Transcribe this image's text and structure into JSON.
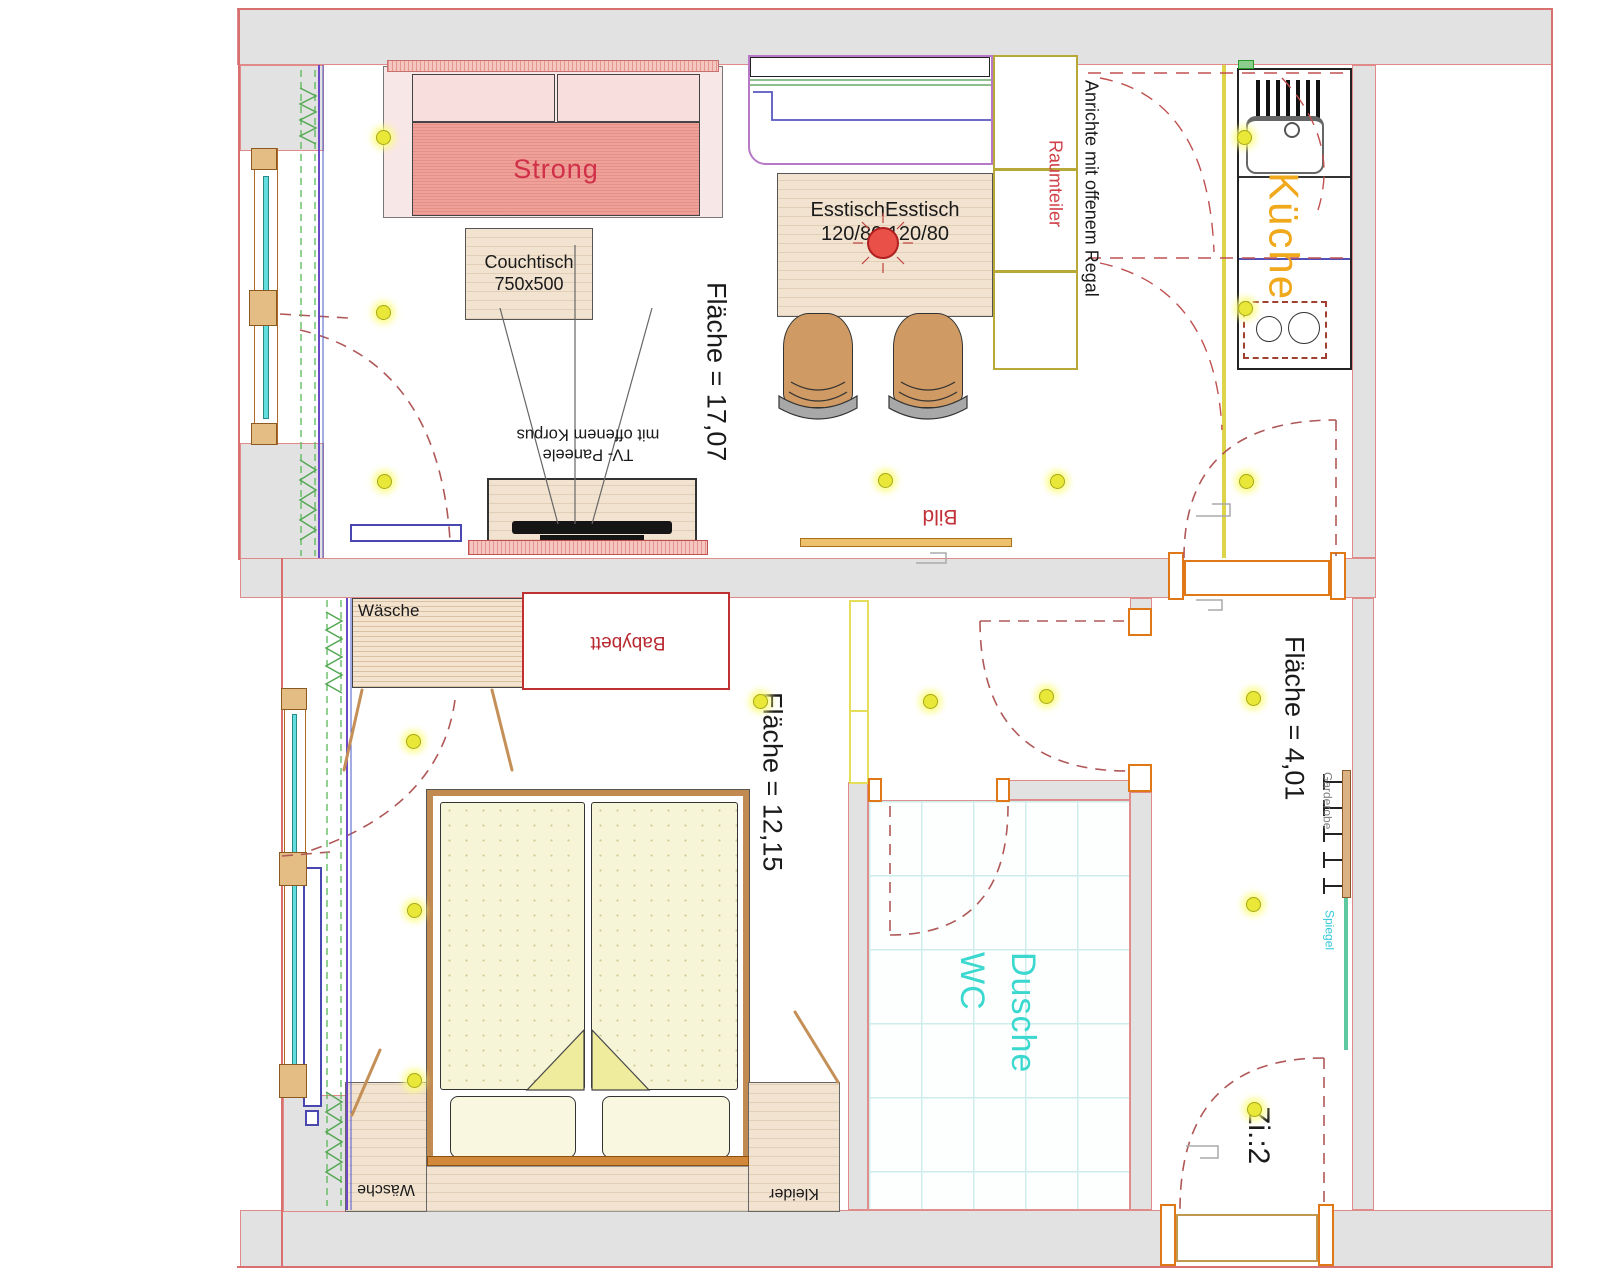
{
  "plan": {
    "living_room": {
      "sofa": "Strong",
      "coffee_table_name": "Couchtisch",
      "coffee_table_size": "750x500",
      "dining_table_name": "EsstischEsstisch",
      "dining_table_size": "120/80 120/80",
      "area": "Fläche = 17,07",
      "tv_line1": "TV- Paneele",
      "tv_line2": "mit offenem Korpus",
      "picture": "Bild",
      "room_divider": "Raumteiler",
      "sideboard": "Anrichte mit offenem Regal"
    },
    "kitchen": {
      "name": "Küche"
    },
    "bedroom": {
      "wardrobe_top": "Wäsche",
      "baby_bed": "Babybett",
      "area": "Fläche = 12,15",
      "wardrobe_bottom": "Wäsche",
      "closet": "Kleider"
    },
    "bathroom": {
      "line1": "Dusche",
      "line2": "WC"
    },
    "hallway": {
      "area": "Fläche = 4,01",
      "coat_rack": "Garderobe",
      "mirror": "Spiegel",
      "room_number": "Zi.:2"
    },
    "colors": {
      "wall_fill": "#e2e2e2",
      "wall_line": "#d87070",
      "accent_red": "#c23038",
      "wood": "#f2e3d0",
      "sofa_seat": "#efa098",
      "light_yellow": "#e9e838",
      "bath_cyan": "#3ad8ce",
      "kitchen_orange": "#f0a81c",
      "door_orange": "#e07818",
      "glass_cyan": "#62dede"
    }
  }
}
